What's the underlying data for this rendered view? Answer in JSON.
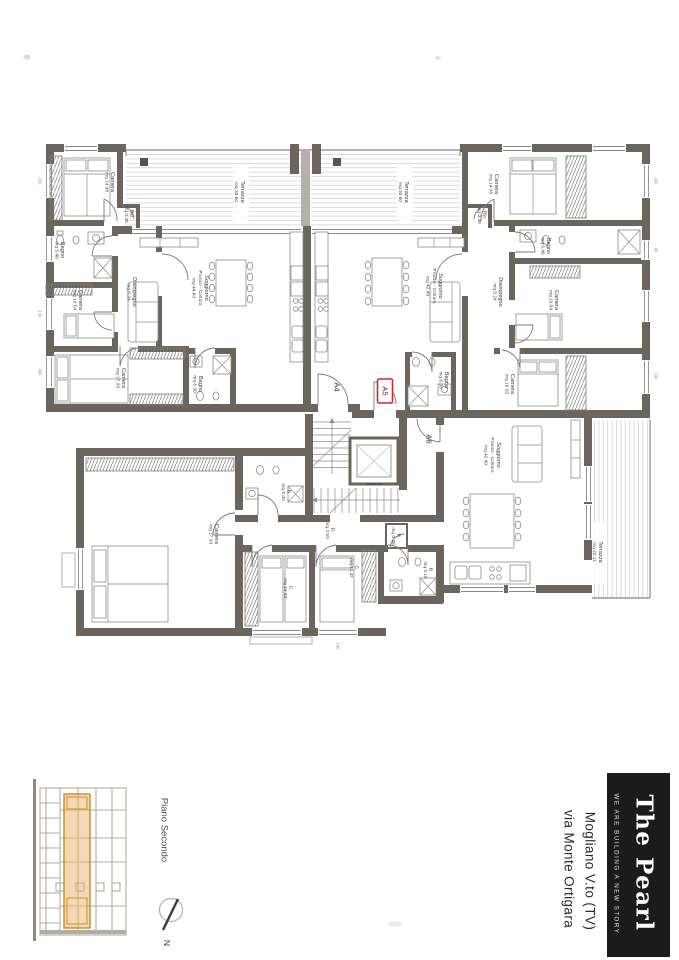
{
  "document": {
    "type": "architectural floor plan scan",
    "floor_label": "Piano Secondo",
    "north_label": "N"
  },
  "title_block": {
    "brand": "The Pearl",
    "tagline": "WE ARE BUILDING A NEW STORY",
    "address_line1": "Mogliano V.to (TV)",
    "address_line2": "via Monte Ortigara",
    "brand_bg": "#1b1b1b",
    "brand_fg": "#ffffff"
  },
  "plan": {
    "colors": {
      "wall": "#6b655e",
      "light_partition": "#b6b0a8",
      "highlight_red": "#cc2b2b",
      "section_highlight_fill": "#ecb468",
      "section_highlight_stroke": "#c8882d"
    },
    "units": [
      {
        "id": "A4",
        "rooms": [
          {
            "name": "Camera",
            "area": "mq 14.08"
          },
          {
            "name": "Rip.",
            "area": "mq 0.48"
          },
          {
            "name": "Bagno",
            "area": "mq 5.46"
          },
          {
            "name": "Camera",
            "area": "mq 10.54"
          },
          {
            "name": "Disimpegno",
            "area": "mq 5.24"
          },
          {
            "name": "Soggiorno",
            "name2": "Pranzo - Cottura",
            "area": "mq 44.60"
          },
          {
            "name": "Camera",
            "area": "mq 17.03"
          },
          {
            "name": "Bagno",
            "area": "mq 6.30"
          },
          {
            "name": "Terrazza",
            "area": "mq 30.60"
          }
        ]
      },
      {
        "id": "A5",
        "rooms": [
          {
            "name": "Camera",
            "area": "mq 14.08"
          },
          {
            "name": "Rip.",
            "area": "mq 0.48"
          },
          {
            "name": "Bagno",
            "area": "mq 5.46"
          },
          {
            "name": "Camera",
            "area": "mq 10.54"
          },
          {
            "name": "Disimpegno",
            "area": "mq 5.24"
          },
          {
            "name": "Soggiorno",
            "name2": "Pranzo - Cottura",
            "area": "mq 42.40"
          },
          {
            "name": "Camera",
            "area": "mq 16.03"
          },
          {
            "name": "Bagno",
            "area": "mq 6.30"
          },
          {
            "name": "Terrazza",
            "area": "mq 30.60"
          }
        ]
      },
      {
        "id": "A6",
        "rooms": [
          {
            "name": "Soggiorno",
            "name2": "Pranzo - Cottura",
            "area": "mq 42.40"
          },
          {
            "name": "Camera",
            "area": "mq 17.03"
          },
          {
            "name": "B.",
            "area": "mq 5.00"
          },
          {
            "name": "D.",
            "area": "mq 2.50"
          },
          {
            "name": "R.",
            "area": "mq 0.48"
          },
          {
            "name": "C.",
            "area": "mq 14.43"
          },
          {
            "name": "C.",
            "area": "mq 11.42"
          },
          {
            "name": "B.",
            "area": "mq 5.18"
          },
          {
            "name": "Terrazza",
            "area": "mq 22.11"
          }
        ]
      }
    ],
    "dimensions": [
      "240",
      "160",
      "90"
    ]
  }
}
